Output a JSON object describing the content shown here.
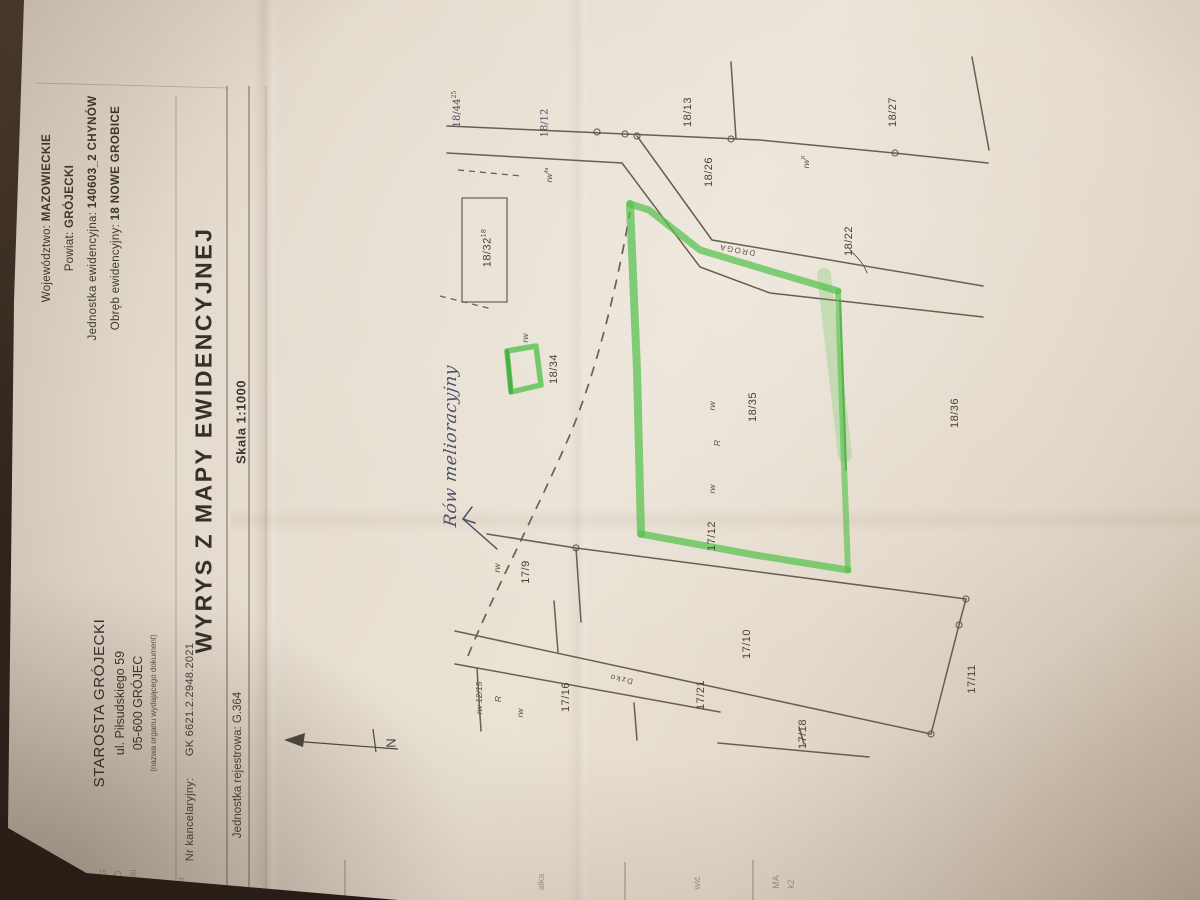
{
  "document": {
    "issuer": {
      "name": "STAROSTA GRÓJECKI",
      "street": "ul. Piłsudskiego 59",
      "city": "05-600 GRÓJEC",
      "caption": "(nazwa organu wydającego dokument)"
    },
    "location": {
      "voivodeship_label": "Województwo:",
      "voivodeship": "MAZOWIECKIE",
      "county_label": "Powiat:",
      "county": "GRÓJECKI",
      "unit_label": "Jednostka ewidencyjna:",
      "unit": "140603_2 CHYNÓW",
      "precinct_label": "Obręb ewidencyjny:",
      "precinct": "18 NOWE GROBICE"
    },
    "case_number_label": "Nr kancelaryjny:",
    "case_number": "GK 6621.2.2948.2021",
    "title": "WYRYS Z MAPY EWIDENCYJNEJ",
    "scale": "Skala 1:1000",
    "register": {
      "label": "Jednostka rejestrowa:",
      "value": "G.364"
    }
  },
  "map": {
    "handwriting": "Rów melioracyjny",
    "colors": {
      "highlight_green": "#56c24c",
      "ink": "#5a5044",
      "pen_ink": "#4d5168",
      "paper": "#e7ded1"
    },
    "labels": [
      {
        "t": "18/13",
        "x": 688,
        "y": 112,
        "cls": "parcel"
      },
      {
        "t": "18/26",
        "x": 709,
        "y": 172,
        "cls": "parcel"
      },
      {
        "t": "18/27",
        "x": 893,
        "y": 112,
        "cls": "parcel"
      },
      {
        "t": "18/22",
        "x": 849,
        "y": 241,
        "cls": "parcel"
      },
      {
        "t": "18/36",
        "x": 955,
        "y": 413,
        "cls": "parcel"
      },
      {
        "t": "18/35",
        "x": 753,
        "y": 407,
        "cls": "parcel"
      },
      {
        "t": "18/34",
        "x": 554,
        "y": 369,
        "cls": "parcel"
      },
      {
        "t": "17/12",
        "x": 712,
        "y": 536,
        "cls": "parcel"
      },
      {
        "t": "17/9",
        "x": 526,
        "y": 572,
        "cls": "parcel"
      },
      {
        "t": "17/10",
        "x": 747,
        "y": 644,
        "cls": "parcel"
      },
      {
        "t": "17/11",
        "x": 972,
        "y": 679,
        "cls": "parcel"
      },
      {
        "t": "17/16",
        "x": 566,
        "y": 697,
        "cls": "parcel"
      },
      {
        "t": "17/21",
        "x": 701,
        "y": 695,
        "cls": "parcel"
      },
      {
        "t": "17/18",
        "x": 803,
        "y": 734,
        "cls": "parcel"
      },
      {
        "t": "18/32",
        "sup": "18",
        "x": 487,
        "y": 248,
        "cls": "parcel"
      },
      {
        "t": "rw",
        "x": 525,
        "y": 338,
        "cls": "marker"
      },
      {
        "t": "rw",
        "x": 712,
        "y": 406,
        "cls": "marker"
      },
      {
        "t": "R",
        "x": 717,
        "y": 443,
        "cls": "marker"
      },
      {
        "t": "rw",
        "x": 712,
        "y": 489,
        "cls": "marker"
      },
      {
        "t": "rw",
        "x": 497,
        "y": 568,
        "cls": "marker"
      },
      {
        "t": "rw",
        "x": 520,
        "y": 713,
        "cls": "marker"
      },
      {
        "t": "R",
        "x": 498,
        "y": 699,
        "cls": "marker"
      },
      {
        "t": "rw",
        "sup": "R",
        "x": 806,
        "y": 162,
        "cls": "marker"
      },
      {
        "t": "rw",
        "sup": "4a",
        "x": 549,
        "y": 175,
        "cls": "marker"
      },
      {
        "t": "rw 12/15",
        "x": 479,
        "y": 698,
        "cls": "marker"
      },
      {
        "t": "18/44",
        "sup": "25",
        "x": 457,
        "y": 109,
        "cls": "pen"
      },
      {
        "t": "18/12",
        "x": 545,
        "y": 123,
        "cls": "pen"
      },
      {
        "t": "DROGA",
        "x": 737,
        "y": 250,
        "cls": "road",
        "rot": 190
      },
      {
        "t": "Dzko",
        "x": 621,
        "y": 679,
        "cls": "road",
        "rot": 192
      },
      {
        "t": "N",
        "x": 391,
        "y": 743,
        "cls": "north"
      },
      {
        "t": "TA G",
        "x": 103,
        "y": 879,
        "cls": "frag"
      },
      {
        "t": "GRÓ",
        "x": 118,
        "y": 881,
        "cls": "frag"
      },
      {
        "t": "udski",
        "x": 133,
        "y": 880,
        "cls": "frag"
      },
      {
        "t": "ręb",
        "x": 181,
        "y": 884,
        "cls": "frag"
      },
      {
        "t": "ałka",
        "x": 541,
        "y": 882,
        "cls": "frag"
      },
      {
        "t": "wić",
        "x": 697,
        "y": 883,
        "cls": "frag"
      },
      {
        "t": "MA",
        "x": 776,
        "y": 882,
        "cls": "frag"
      },
      {
        "t": "k2",
        "x": 791,
        "y": 884,
        "cls": "frag"
      }
    ]
  }
}
